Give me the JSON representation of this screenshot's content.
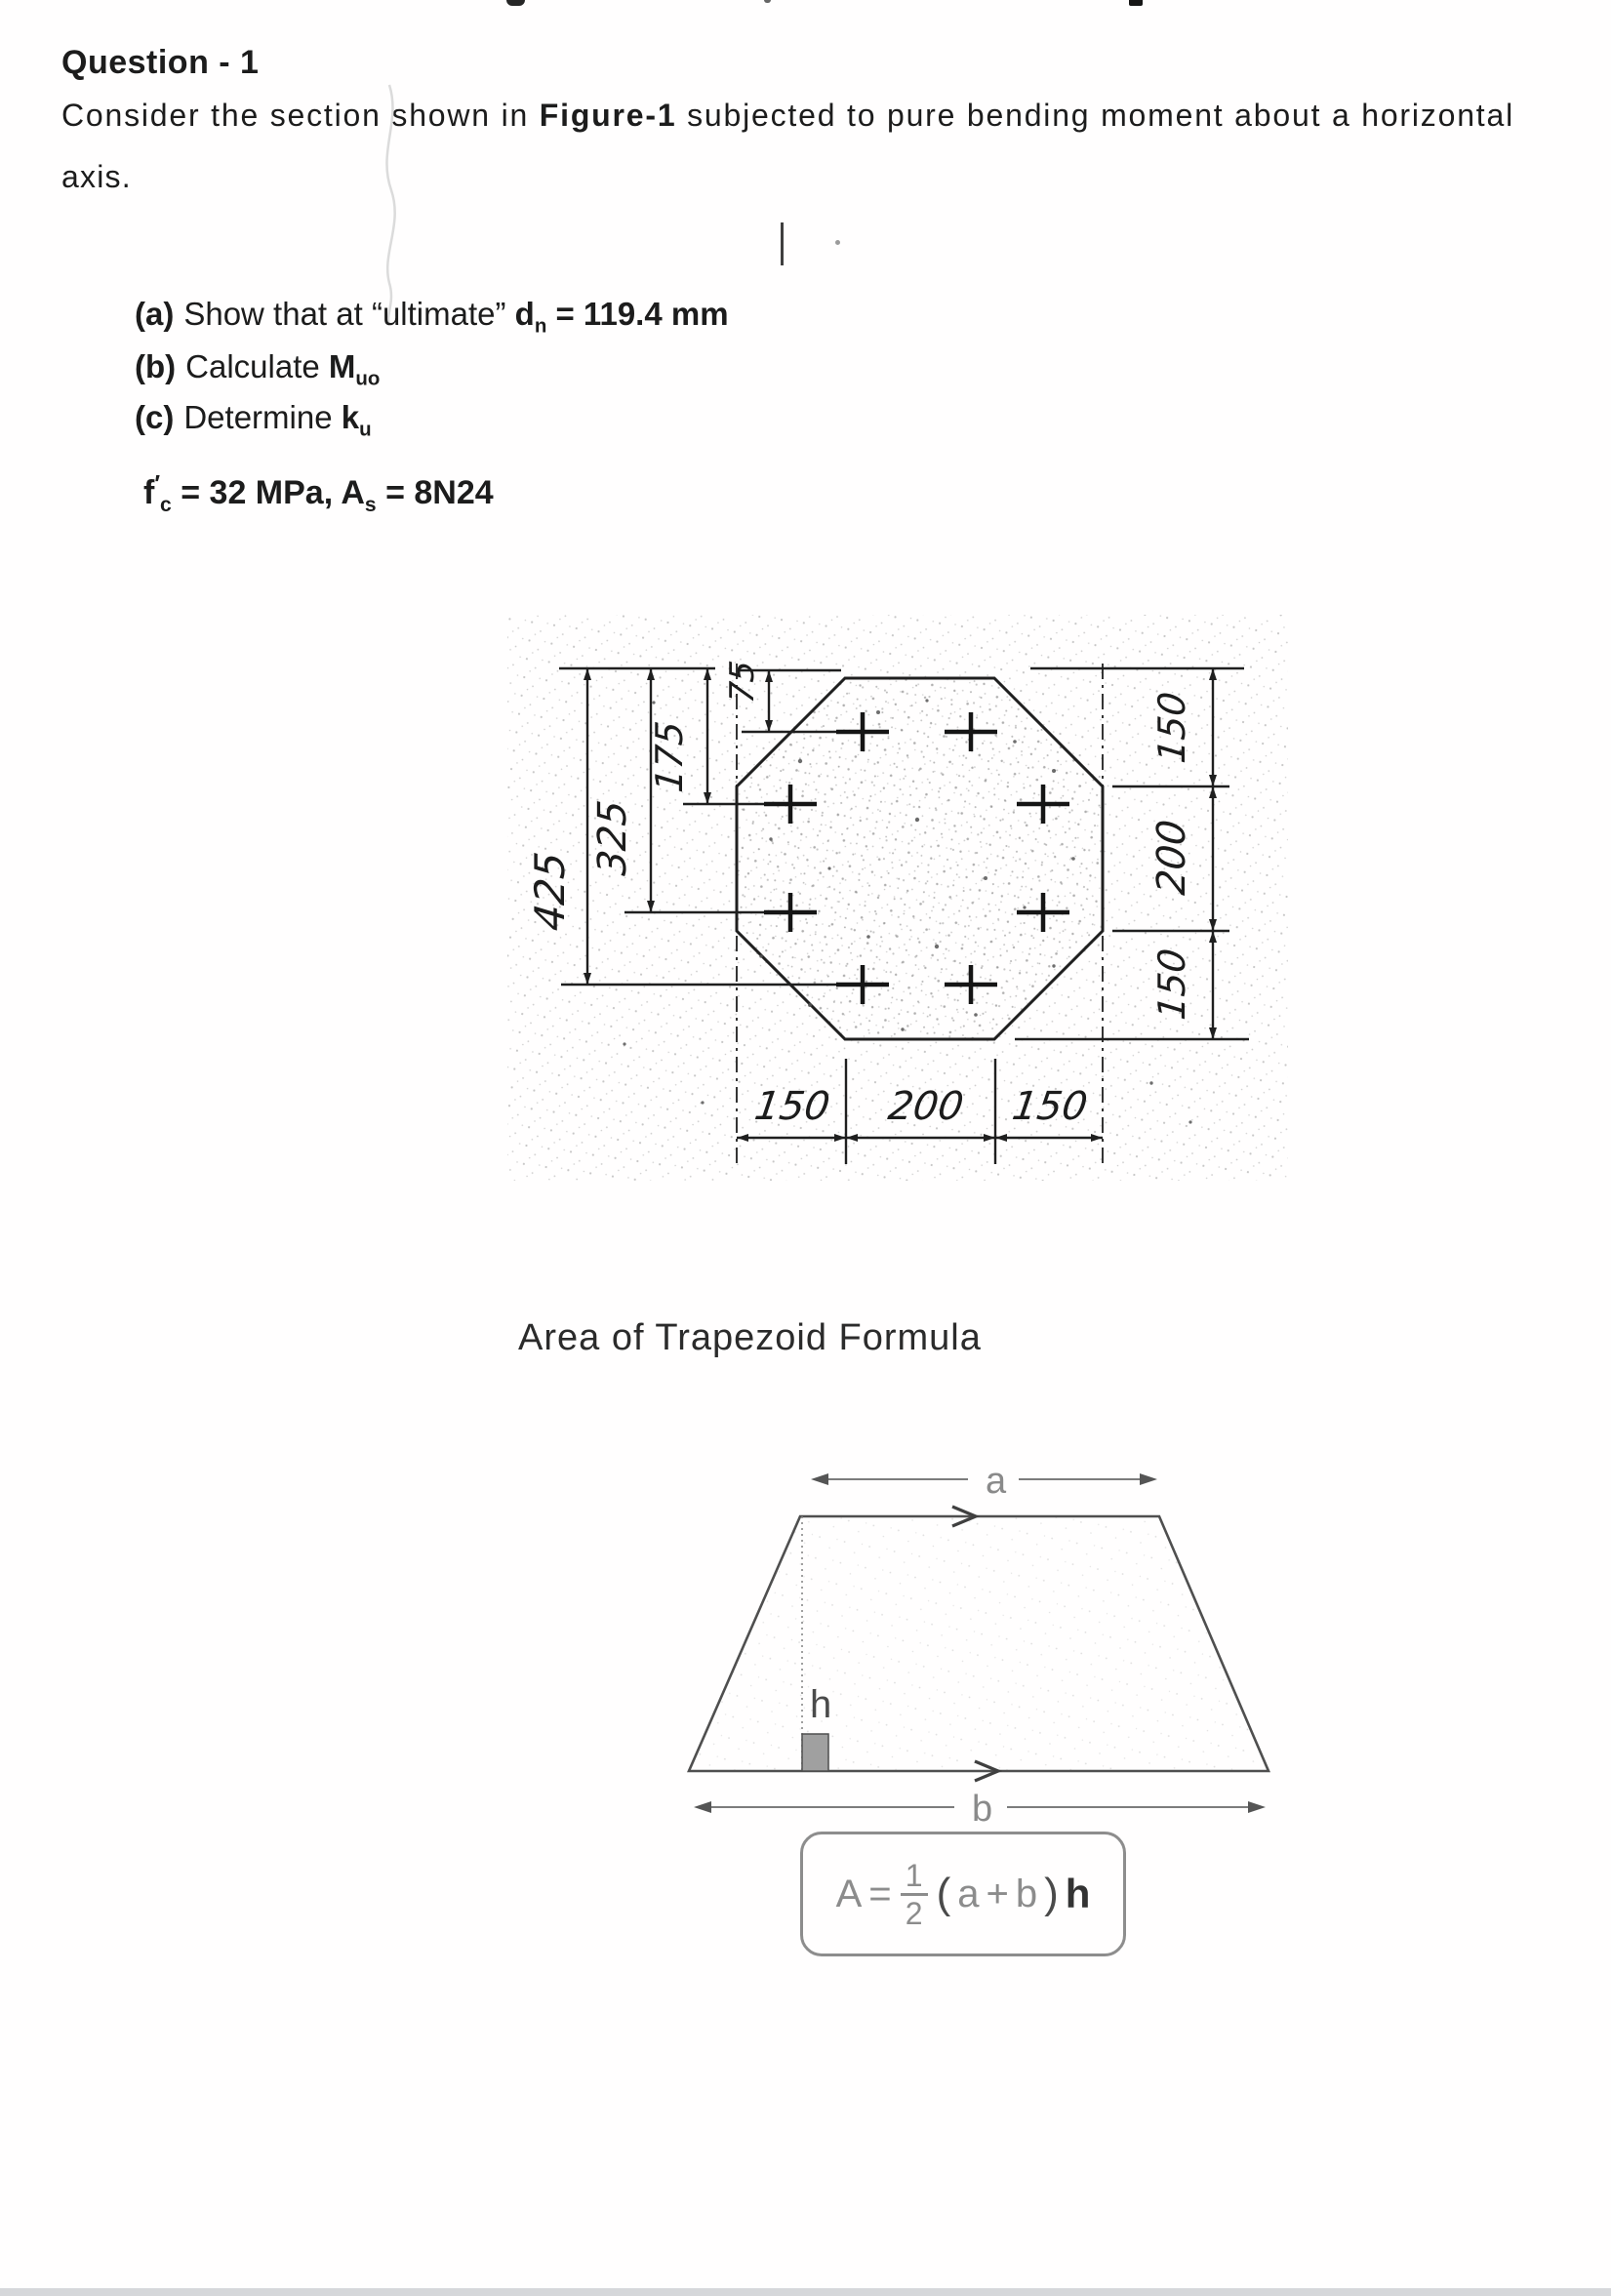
{
  "document": {
    "title": "Question - 1",
    "paragraph": {
      "line1a": "Consider the section shown in ",
      "line1b": "Figure-1",
      "line1c": " subjected to pure bending moment about a horizontal",
      "line2": "axis."
    },
    "parts": {
      "a": {
        "label": "(a)",
        "text": "Show that at “ultimate” ",
        "var": "d",
        "var_sub": "n",
        "value": " = 119.4 mm"
      },
      "b": {
        "label": "(b)",
        "text": "Calculate ",
        "var": "M",
        "var_sub": "uo",
        "value": ""
      },
      "c": {
        "label": "(c)",
        "text": "Determine ",
        "var": "k",
        "var_sub": "u",
        "value": ""
      }
    },
    "given": {
      "sym1": "f",
      "prime": "′",
      "sym1_sub": "c",
      "mid": " = 32 MPa, ",
      "sym2": "A",
      "sym2_sub": "s",
      "end": " = 8N24"
    }
  },
  "figure1": {
    "left_dims": {
      "d425": "425",
      "d325": "325",
      "d175": "175",
      "d75": "75"
    },
    "right_dims": {
      "top": "150",
      "mid": "200",
      "bot": "150"
    },
    "bottom_dims": {
      "left": "150",
      "mid": "200",
      "right": "150"
    }
  },
  "trapezoid": {
    "title": "Area of Trapezoid Formula",
    "labels": {
      "a": "a",
      "b": "b",
      "h": "h"
    },
    "formula": {
      "A": "A",
      "eq": "=",
      "num": "1",
      "den": "2",
      "open": "(",
      "a": "a",
      "plus": "+",
      "b": "b",
      "close": ")",
      "h": "h"
    }
  }
}
